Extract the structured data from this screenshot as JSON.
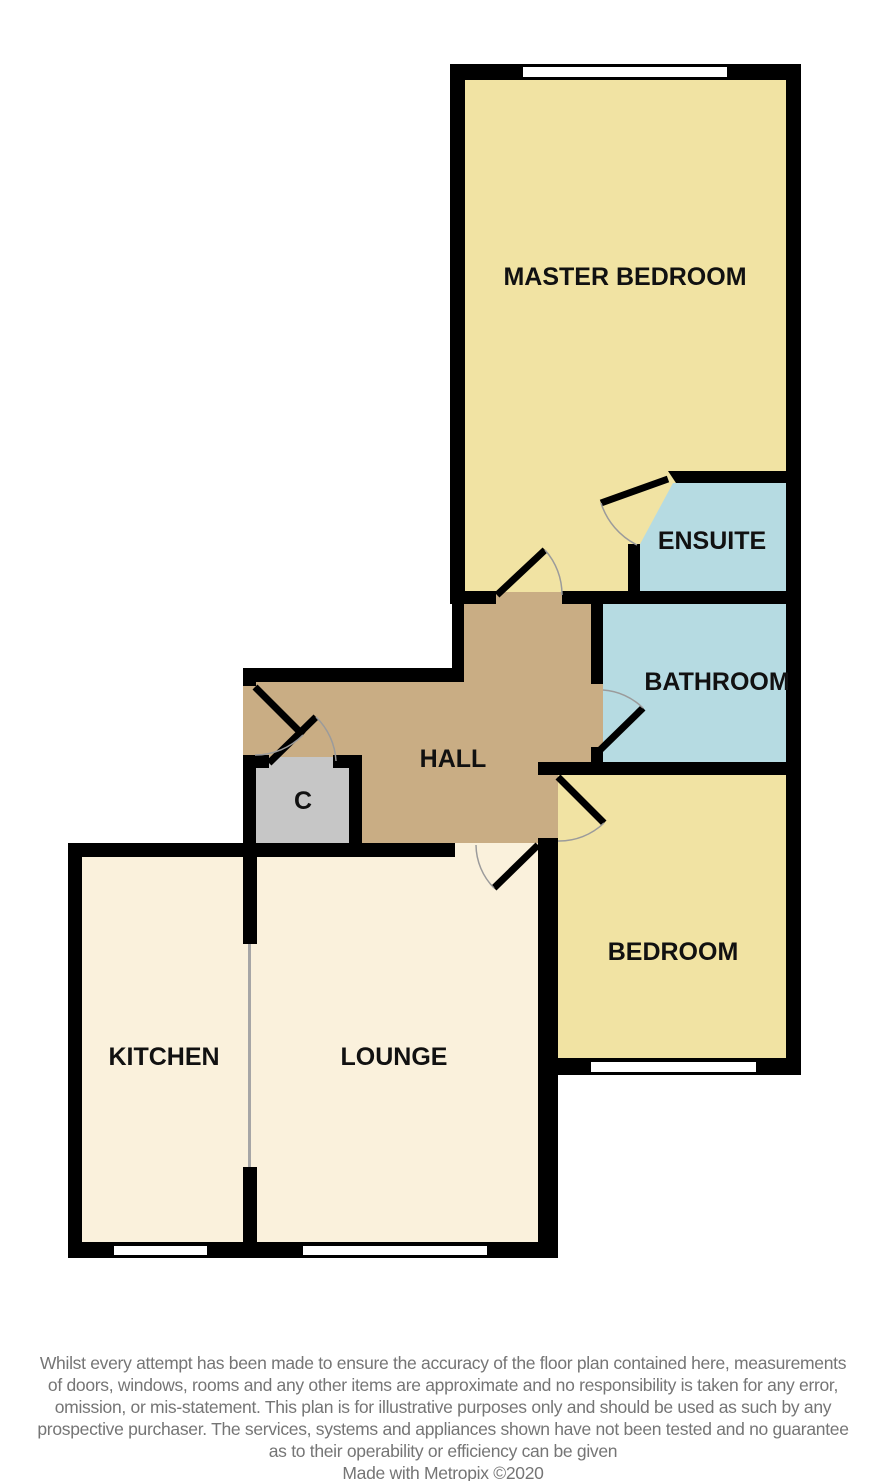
{
  "plan": {
    "rooms": {
      "master_bedroom": {
        "label": "MASTER BEDROOM",
        "color": "#f1e3a3"
      },
      "ensuite": {
        "label": "ENSUITE",
        "color": "#b6dbe2"
      },
      "bathroom": {
        "label": "BATHROOM",
        "color": "#b6dbe2"
      },
      "hall": {
        "label": "HALL",
        "color": "#c9ad84"
      },
      "closet": {
        "label": "C",
        "color": "#c6c6c6"
      },
      "bedroom": {
        "label": "BEDROOM",
        "color": "#f1e3a3"
      },
      "kitchen": {
        "label": "KITCHEN",
        "color": "#faf1dc"
      },
      "lounge": {
        "label": "LOUNGE",
        "color": "#faf1dc"
      }
    },
    "colors": {
      "wall": "#000000",
      "window": "#ffffff",
      "door_arc": "#9b9b9b",
      "divider": "#a6a6a6",
      "label": "#111111"
    }
  },
  "disclaimer": {
    "lines": [
      "Whilst every attempt has been made to ensure the accuracy of the floor plan contained here, measurements",
      "of doors, windows, rooms and any other items are approximate and no responsibility is taken for any error,",
      "omission, or mis-statement. This plan is for illustrative purposes only and should be used as such by any",
      "prospective purchaser. The services, systems and appliances shown have not been tested and no guarantee",
      "as to their operability or efficiency can be given"
    ],
    "credit": "Made with Metropix ©2020"
  }
}
